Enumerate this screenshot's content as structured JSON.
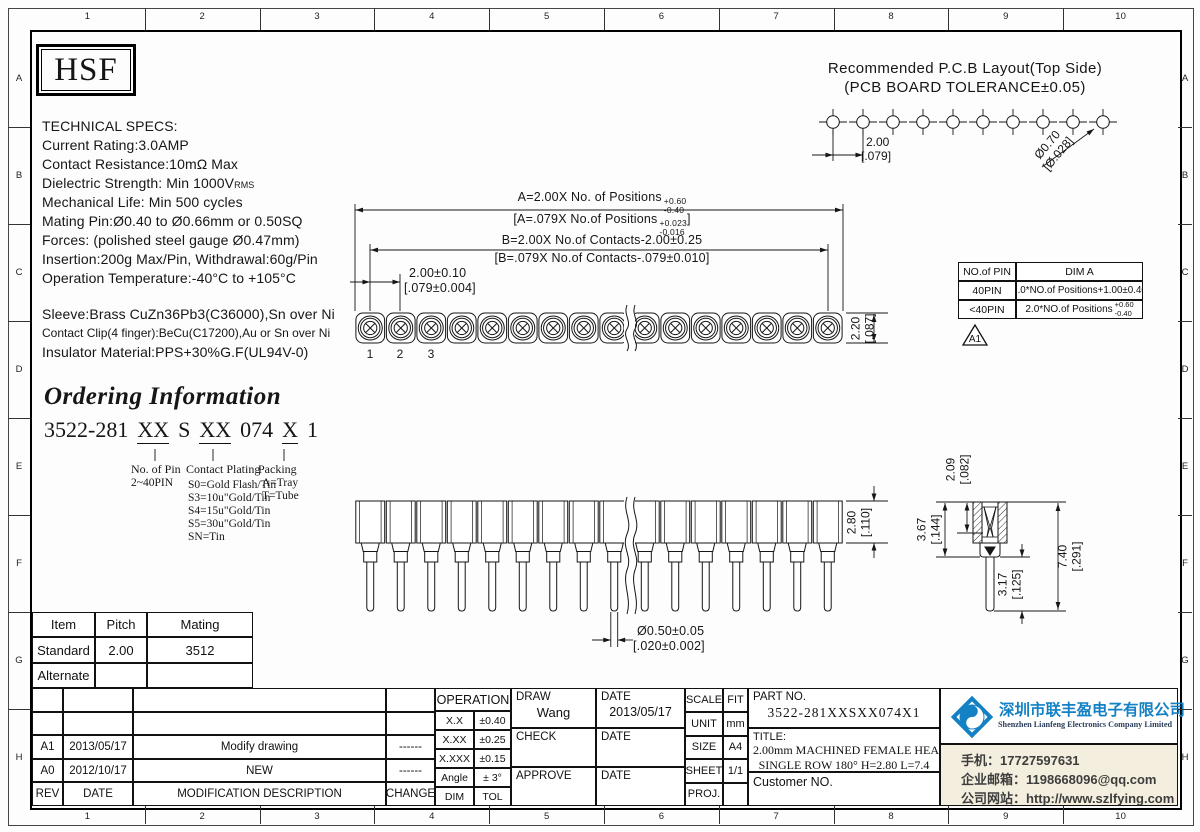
{
  "frame": {
    "cols": [
      "1",
      "2",
      "3",
      "4",
      "5",
      "6",
      "7",
      "8",
      "9",
      "10"
    ],
    "rows": [
      "A",
      "B",
      "C",
      "D",
      "E",
      "F",
      "G",
      "H"
    ]
  },
  "logo": {
    "text": "HSF"
  },
  "tech_specs": {
    "title": "TECHNICAL SPECS:",
    "current": "Current Rating:3.0AMP",
    "resistance": "Contact Resistance:10mΩ Max",
    "dielectric_pre": "Dielectric Strength: Min 1000V",
    "dielectric_sub": "RMS",
    "life": "Mechanical Life: Min 500 cycles",
    "mating": "Mating Pin:Ø0.40 to Ø0.66mm or 0.50SQ",
    "forces": "Forces: (polished steel gauge Ø0.47mm)",
    "insertion": "Insertion:200g Max/Pin,  Withdrawal:60g/Pin",
    "temperature": "Operation Temperature:-40°C to +105°C"
  },
  "materials": {
    "sleeve": "Sleeve:Brass CuZn36Pb3(C36000),Sn over Ni",
    "clip": "Contact Clip(4 finger):BeCu(C17200),Au or Sn over Ni",
    "insulator": "Insulator Material:PPS+30%G.F(UL94V-0)"
  },
  "ordering": {
    "title": "Ordering Information",
    "code_prefix": "3522-281",
    "code_pin": "XX",
    "code_s": "S",
    "code_plating": "XX",
    "code_074": "074",
    "code_packing": "X",
    "code_suffix": "1",
    "pin_label": "No. of Pin",
    "pin_range": "2~40PIN",
    "plating_label": "Contact Plating",
    "plating_options": [
      "S0=Gold Flash/Tin",
      "S3=10u\"Gold/Tin",
      "S4=15u\"Gold/Tin",
      "S5=30u\"Gold/Tin",
      "SN=Tin"
    ],
    "packing_label": "Packing",
    "packing_options": [
      "A=Tray",
      "T=Tube"
    ]
  },
  "pcb": {
    "title1": "Recommended P.C.B Layout(Top Side)",
    "title2": "(PCB BOARD TOLERANCE±0.05)",
    "pitch": "2.00",
    "pitch_in": "[.079]",
    "hole": "Ø0.70",
    "hole_in": "[Ø.028]",
    "holes_shown": 10
  },
  "dims": {
    "a_pre": "A=2.00X No. of Positions",
    "a_plus": "+0.60",
    "a_minus": "-0.40",
    "ai_pre": "[A=.079X No.of Positions",
    "ai_plus": "+0.023",
    "ai_minus": "-0.016",
    "ai_close": "]",
    "b_metric": "B=2.00X No.of Contacts-2.00±0.25",
    "b_inch": "[B=.079X No.of Contacts-.079±0.010]",
    "pitch": "2.00±0.10",
    "pitch_in": "[.079±0.004]",
    "height": "2.20",
    "height_in": "[.087]",
    "body": "2.80",
    "body_in": "[.110]",
    "depth": "2.09",
    "depth_in": "[.082]",
    "sleeve": "3.67",
    "sleeve_in": "[.144]",
    "overall": "7.40",
    "overall_in": "[.291]",
    "tail": "3.17",
    "tail_in": "[.125]",
    "pin_dia": "Ø0.50±0.05",
    "pin_dia_in": "[.020±0.002]",
    "pins": [
      "1",
      "2",
      "3"
    ],
    "positions_shown": 16
  },
  "dim_table": {
    "h1": "NO.of PIN",
    "h2": "DIM A",
    "r1_pin": "40PIN",
    "r1_dim": "2.0*NO.of Positions+1.00±0.40",
    "r2_pin": "<40PIN",
    "r2_dim": "2.0*NO.of Positions",
    "r2_plus": "+0.60",
    "r2_minus": "-0.40",
    "rev_flag": "A1"
  },
  "item_table": {
    "h_item": "Item",
    "h_pitch": "Pitch",
    "h_mating": "Mating",
    "r1": [
      "Standard",
      "2.00",
      "3512"
    ],
    "r2": [
      "Alternate",
      "",
      ""
    ]
  },
  "rev_table": {
    "rows": [
      [
        "",
        "",
        "",
        ""
      ],
      [
        "",
        "",
        "",
        ""
      ],
      [
        "A1",
        "2013/05/17",
        "Modify drawing",
        "------"
      ],
      [
        "A0",
        "2012/10/17",
        "NEW",
        "------"
      ],
      [
        "REV",
        "DATE",
        "MODIFICATION DESCRIPTION",
        "CHANGE"
      ]
    ]
  },
  "title_block": {
    "operation": {
      "header": "OPERATION",
      "rows": [
        [
          "X.X",
          "±0.40"
        ],
        [
          "X.XX",
          "±0.25"
        ],
        [
          "X.XXX",
          "±0.15"
        ],
        [
          "Angle",
          "± 3°"
        ],
        [
          "DIM",
          "TOL"
        ]
      ]
    },
    "sign": {
      "draw": "DRAW",
      "draw_name": "Wang",
      "date": "DATE",
      "draw_date": "2013/05/17",
      "check": "CHECK",
      "approve": "APPROVE"
    },
    "meta": {
      "rows": [
        [
          "SCALE",
          "FIT"
        ],
        [
          "UNIT",
          "mm"
        ],
        [
          "SIZE",
          "A4"
        ],
        [
          "SHEET",
          "1/1"
        ],
        [
          "PROJ.",
          ""
        ]
      ]
    },
    "part_label": "PART NO.",
    "part_no": "3522-281XXSXX074X1",
    "title_label": "TITLE:",
    "title1": "2.00mm MACHINED FEMALE HEADER",
    "title2": "SINGLE ROW 180° H=2.80 L=7.4",
    "customer": "Customer NO."
  },
  "company": {
    "cn": "深圳市联丰盈电子有限公司",
    "en": "Shenzhen Lianfeng Electronics Company Limited",
    "phone": "手机：17727597631",
    "email": "企业邮箱：1198668096@qq.com",
    "web": "公司网站：http://www.szlfying.com",
    "accent": "#1581c5"
  }
}
